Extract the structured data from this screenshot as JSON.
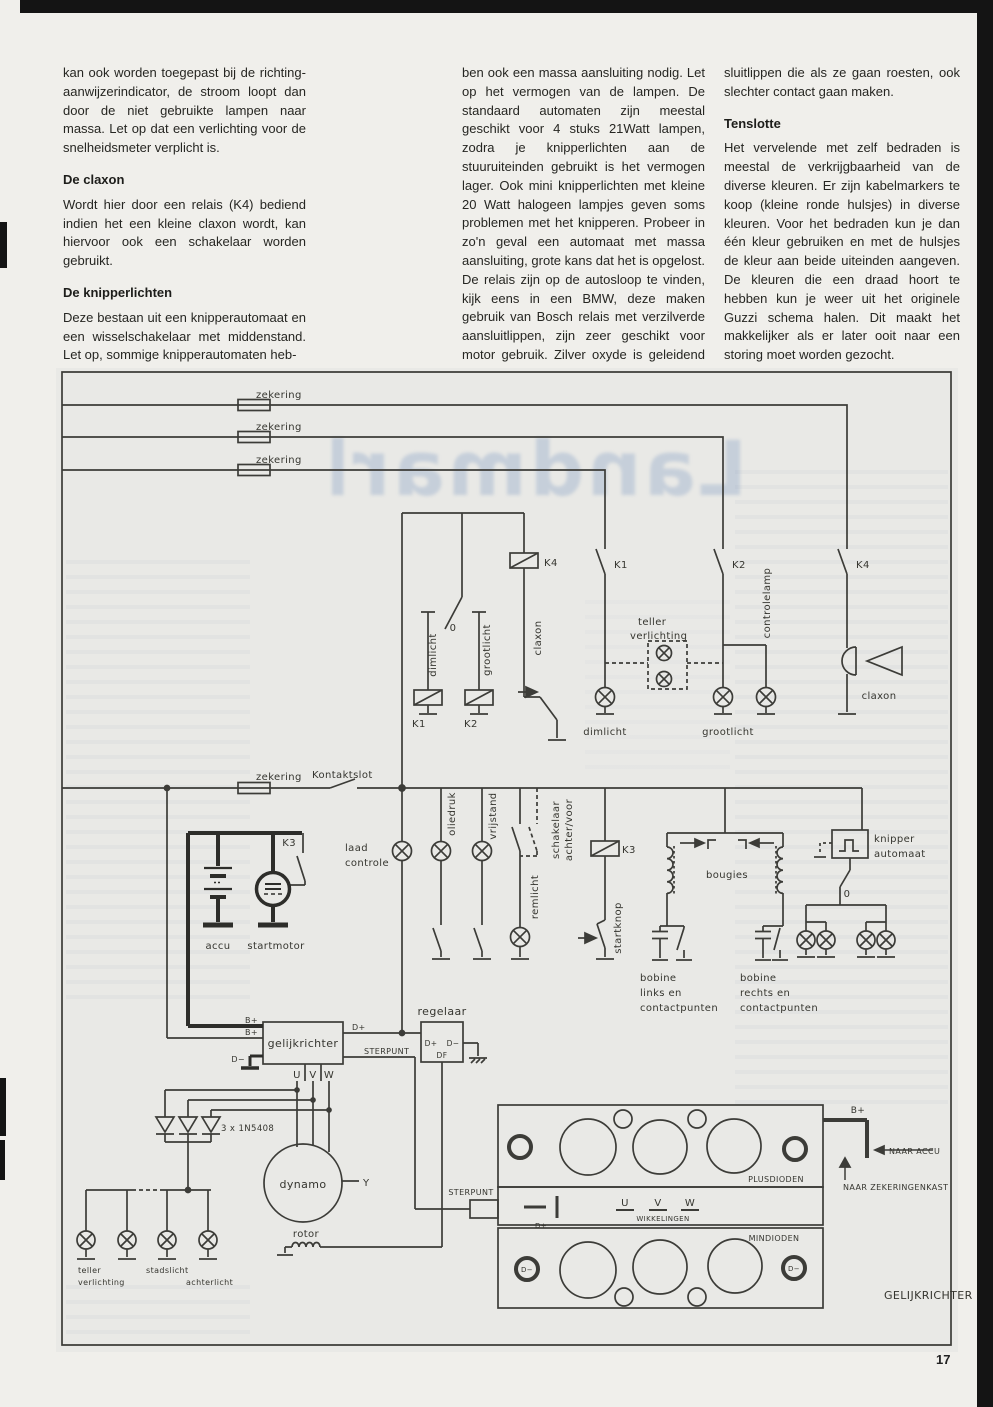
{
  "page": {
    "number": "17",
    "ghost_title": "Landmarks"
  },
  "article": {
    "col1": {
      "p1": "kan ook worden toegepast bij de richting­aanwijzerindicator, de stroom loopt dan door de niet gebruikte lampen naar massa. Let op dat een verlichting voor de snelheidsmeter verplicht is.",
      "h1": "De claxon",
      "p2": "Wordt hier door een relais (K4) bediend indien het een kleine claxon wordt, kan hiervoor ook een schakelaar worden gebruikt.",
      "h2": "De knipperlichten",
      "p3": "Deze bestaan uit een knipperautomaat en een wisselschakelaar met middenstand. Let op, sommige knipperautomaten heb-"
    },
    "col2": {
      "p1": "ben ook een massa aansluiting nodig. Let op het vermogen van de lampen. De standaard automaten zijn meestal geschikt voor 4 stuks 21Watt lampen, zodra je knipperlichten aan de stuuruiteinden gebruikt is het vermogen lager. Ook mini knipperlichten met kleine 20 Watt halogeen lampjes geven soms problemen met het knipperen. Probeer in zo'n geval een automaat met massa aansluiting, grote kans dat het is opgelost. De relais zijn op de autosloop te vinden, kijk eens in een BMW, deze maken gebruik van Bosch relais met verzilverde aansluitlippen, zijn zeer geschikt voor motor gebruik. Zilver oxyde is geleidend en de standaard relais hebben messing aan-"
    },
    "col3": {
      "p1": "sluitlippen die als ze gaan roesten, ook slechter contact gaan maken.",
      "h1": "Tenslotte",
      "p2": "Het vervelende met zelf bedraden is meestal de verkrijgbaarheid van de diverse kleuren. Er zijn kabelmarkers te koop (kleine ronde hulsjes) in diverse kleuren. Voor het bedraden kun je dan één kleur gebruiken en met de hulsjes de kleur aan beide uiteinden aangeven. De kleuren die een draad hoort te hebben kun je weer uit het originele Guzzi schema halen. Dit maakt het makkelijker als er later ooit naar een storing moet worden gezocht."
    }
  },
  "diagram": {
    "colors": {
      "wire": "#3c3c38",
      "thick": "#2d2d2a",
      "paper": "#e9e9e6"
    },
    "labels": [
      {
        "id": "zekering-1",
        "t": "zekering",
        "x": 256,
        "y": 398
      },
      {
        "id": "zekering-2",
        "t": "zekering",
        "x": 256,
        "y": 430
      },
      {
        "id": "zekering-3",
        "t": "zekering",
        "x": 256,
        "y": 463
      },
      {
        "id": "k4-contact",
        "t": "K4",
        "x": 856,
        "y": 568
      },
      {
        "id": "k1-contact",
        "t": "K1",
        "x": 614,
        "y": 568
      },
      {
        "id": "k2-contact",
        "t": "K2",
        "x": 732,
        "y": 568
      },
      {
        "id": "k4-coil",
        "t": "K4",
        "x": 544,
        "y": 566
      },
      {
        "id": "selector-zero",
        "t": "0",
        "x": 453,
        "y": 631,
        "a": "middle"
      },
      {
        "id": "dimlicht-wire",
        "t": "dimlicht",
        "x": 436,
        "y": 655,
        "r": -90,
        "a": "middle"
      },
      {
        "id": "grootlicht-wire",
        "t": "grootlicht",
        "x": 490,
        "y": 650,
        "r": -90,
        "a": "middle"
      },
      {
        "id": "claxon-wire",
        "t": "claxon",
        "x": 541,
        "y": 638,
        "r": -90,
        "a": "middle"
      },
      {
        "id": "k1-coil",
        "t": "K1",
        "x": 412,
        "y": 727
      },
      {
        "id": "k2-coil",
        "t": "K2",
        "x": 464,
        "y": 727
      },
      {
        "id": "teller-verl-1",
        "t": "teller",
        "x": 638,
        "y": 625
      },
      {
        "id": "teller-verl-2",
        "t": "verlichting",
        "x": 630,
        "y": 639
      },
      {
        "id": "dimlicht-lamp",
        "t": "dimlicht",
        "x": 605,
        "y": 735,
        "a": "middle"
      },
      {
        "id": "grootlicht-lamp",
        "t": "grootlicht",
        "x": 728,
        "y": 735,
        "a": "middle"
      },
      {
        "id": "controlelamp",
        "t": "controlelamp",
        "x": 770,
        "y": 603,
        "r": -90,
        "a": "middle"
      },
      {
        "id": "claxon-horn",
        "t": "claxon",
        "x": 879,
        "y": 699,
        "a": "middle"
      },
      {
        "id": "zekering-4",
        "t": "zekering",
        "x": 256,
        "y": 780
      },
      {
        "id": "kontaktslot",
        "t": "Kontaktslot",
        "x": 312,
        "y": 778
      },
      {
        "id": "k3-contact",
        "t": "K3",
        "x": 296,
        "y": 846,
        "a": "end"
      },
      {
        "id": "accu",
        "t": "accu",
        "x": 218,
        "y": 949,
        "a": "middle"
      },
      {
        "id": "startmotor",
        "t": "startmotor",
        "x": 276,
        "y": 949,
        "a": "middle"
      },
      {
        "id": "laad-1",
        "t": "laad",
        "x": 345,
        "y": 851
      },
      {
        "id": "laad-2",
        "t": "controle",
        "x": 345,
        "y": 866
      },
      {
        "id": "oliedruk",
        "t": "oliedruk",
        "x": 455,
        "y": 814,
        "r": -90,
        "a": "middle"
      },
      {
        "id": "vrijstand",
        "t": "vrijstand",
        "x": 496,
        "y": 816,
        "r": -90,
        "a": "middle"
      },
      {
        "id": "remlicht",
        "t": "remlicht",
        "x": 538,
        "y": 897,
        "r": -90,
        "a": "middle"
      },
      {
        "id": "schakelaar-1",
        "t": "schakelaar",
        "x": 559,
        "y": 830,
        "r": -90,
        "a": "middle"
      },
      {
        "id": "schakelaar-2",
        "t": "achter/voor",
        "x": 572,
        "y": 830,
        "r": -90,
        "a": "middle"
      },
      {
        "id": "k3-coil",
        "t": "K3",
        "x": 622,
        "y": 853
      },
      {
        "id": "startknop",
        "t": "startknop",
        "x": 621,
        "y": 928,
        "r": -90,
        "a": "middle"
      },
      {
        "id": "bougies",
        "t": "bougies",
        "x": 727,
        "y": 878,
        "a": "middle"
      },
      {
        "id": "knipper-1",
        "t": "knipper",
        "x": 874,
        "y": 842
      },
      {
        "id": "knipper-2",
        "t": "automaat",
        "x": 874,
        "y": 857
      },
      {
        "id": "knipper-zero",
        "t": "0",
        "x": 847,
        "y": 897,
        "a": "middle"
      },
      {
        "id": "bobine-l-1",
        "t": "bobine",
        "x": 640,
        "y": 981
      },
      {
        "id": "bobine-l-2",
        "t": "links en",
        "x": 640,
        "y": 996
      },
      {
        "id": "bobine-l-3",
        "t": "contactpunten",
        "x": 640,
        "y": 1011
      },
      {
        "id": "bobine-r-1",
        "t": "bobine",
        "x": 740,
        "y": 981
      },
      {
        "id": "bobine-r-2",
        "t": "rechts en",
        "x": 740,
        "y": 996
      },
      {
        "id": "bobine-r-3",
        "t": "contactpunten",
        "x": 740,
        "y": 1011
      },
      {
        "id": "regelaar",
        "t": "regelaar",
        "x": 442,
        "y": 1015,
        "a": "middle",
        "s": 11
      },
      {
        "id": "reg-dplus",
        "t": "D+",
        "x": 431,
        "y": 1046,
        "s": 7.5,
        "a": "middle"
      },
      {
        "id": "reg-dmin",
        "t": "D−",
        "x": 453,
        "y": 1046,
        "s": 7.5,
        "a": "middle"
      },
      {
        "id": "reg-df",
        "t": "DF",
        "x": 442,
        "y": 1058,
        "s": 7.5,
        "a": "middle"
      },
      {
        "id": "gelijkrichter-box",
        "t": "gelijkrichter",
        "x": 303,
        "y": 1047,
        "s": 11,
        "a": "middle"
      },
      {
        "id": "bplus-1",
        "t": "B+",
        "x": 258,
        "y": 1023,
        "s": 8,
        "a": "end"
      },
      {
        "id": "bplus-2",
        "t": "B+",
        "x": 258,
        "y": 1035,
        "s": 8,
        "a": "end"
      },
      {
        "id": "dmin-label",
        "t": "D−",
        "x": 245,
        "y": 1062,
        "s": 8,
        "a": "end"
      },
      {
        "id": "dplus-out",
        "t": "D+",
        "x": 352,
        "y": 1030,
        "s": 8
      },
      {
        "id": "sterpunt-1",
        "t": "STERPUNT",
        "x": 364,
        "y": 1054,
        "s": 8
      },
      {
        "id": "u-out",
        "t": "U",
        "x": 297,
        "y": 1078,
        "a": "middle"
      },
      {
        "id": "v-out",
        "t": "V",
        "x": 313,
        "y": 1078,
        "a": "middle"
      },
      {
        "id": "w-out",
        "t": "W",
        "x": 329,
        "y": 1078,
        "a": "middle"
      },
      {
        "id": "diodes",
        "t": "3 x 1N5408",
        "x": 221,
        "y": 1131,
        "s": 8.5
      },
      {
        "id": "dynamo",
        "t": "dynamo",
        "x": 303,
        "y": 1188,
        "s": 11,
        "a": "middle"
      },
      {
        "id": "y-terminal",
        "t": "Y",
        "x": 363,
        "y": 1186
      },
      {
        "id": "rotor",
        "t": "rotor",
        "x": 306,
        "y": 1237,
        "a": "middle"
      },
      {
        "id": "sterpunt-2",
        "t": "STERPUNT",
        "x": 471,
        "y": 1195,
        "s": 8,
        "a": "middle"
      },
      {
        "id": "lamp-teller-1",
        "t": "teller",
        "x": 78,
        "y": 1273,
        "s": 8
      },
      {
        "id": "lamp-teller-2",
        "t": "verlichting",
        "x": 78,
        "y": 1285,
        "s": 8
      },
      {
        "id": "stadslicht",
        "t": "stadslicht",
        "x": 146,
        "y": 1273,
        "s": 8
      },
      {
        "id": "achterlicht",
        "t": "achterlicht",
        "x": 186,
        "y": 1285,
        "s": 8
      },
      {
        "id": "plusdioden",
        "t": "PLUSDIODEN",
        "x": 776,
        "y": 1182,
        "s": 8,
        "a": "middle"
      },
      {
        "id": "mindioden",
        "t": "MINDIODEN",
        "x": 774,
        "y": 1241,
        "s": 8,
        "a": "middle"
      },
      {
        "id": "strip-dplus",
        "t": "D+",
        "x": 541,
        "y": 1228,
        "s": 7,
        "a": "middle"
      },
      {
        "id": "strip-u",
        "t": "U",
        "x": 625,
        "y": 1206,
        "s": 10,
        "a": "middle"
      },
      {
        "id": "strip-v",
        "t": "V",
        "x": 658,
        "y": 1206,
        "s": 10,
        "a": "middle"
      },
      {
        "id": "strip-w",
        "t": "W",
        "x": 690,
        "y": 1206,
        "s": 10,
        "a": "middle"
      },
      {
        "id": "wikkelingen",
        "t": "WIKKELINGEN",
        "x": 663,
        "y": 1221,
        "s": 7,
        "a": "middle"
      },
      {
        "id": "dmin-ring-l",
        "t": "D−",
        "x": 527,
        "y": 1272,
        "s": 7,
        "a": "middle"
      },
      {
        "id": "dmin-ring-r",
        "t": "D−",
        "x": 794,
        "y": 1271,
        "s": 7,
        "a": "middle"
      },
      {
        "id": "bplus-out",
        "t": "B+",
        "x": 858,
        "y": 1113,
        "s": 9,
        "a": "middle"
      },
      {
        "id": "naar-accu",
        "t": "NAAR ACCU",
        "x": 889,
        "y": 1154,
        "s": 8
      },
      {
        "id": "naar-zekeringenkast",
        "t": "NAAR ZEKERINGENKAST",
        "x": 843,
        "y": 1190,
        "s": 8
      },
      {
        "id": "gelijkrichter-big",
        "t": "GELIJKRICHTER",
        "x": 884,
        "y": 1299,
        "s": 11
      }
    ]
  }
}
